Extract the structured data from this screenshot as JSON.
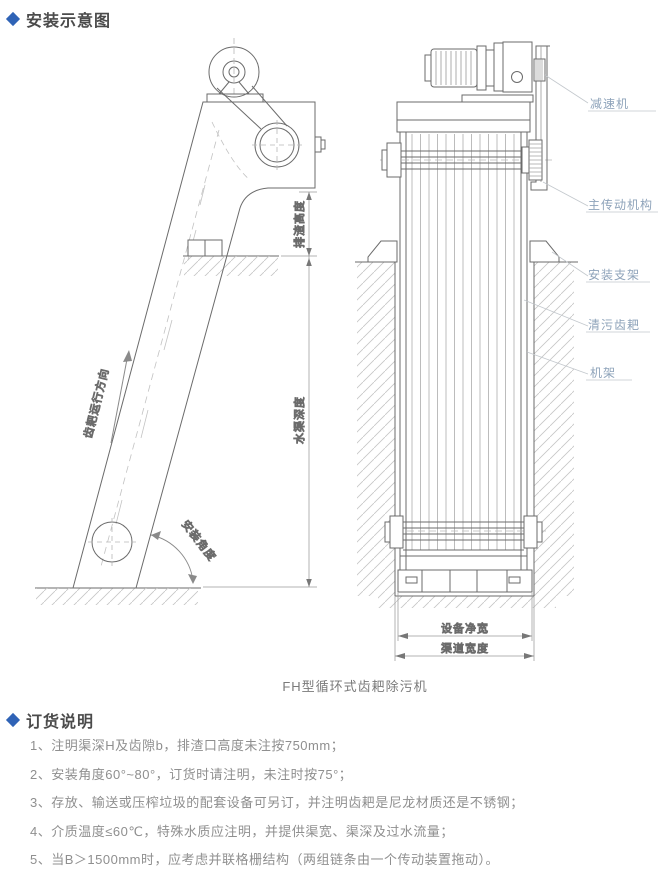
{
  "page": {
    "install_title": "安装示意图",
    "order_title": "订货说明",
    "caption": "FH型循环式齿耙除污机",
    "accent_color": "#2f63b6"
  },
  "diagram": {
    "part_labels": {
      "reducer": "减速机",
      "main_drive": "主传动机构",
      "mount_bracket": "安装支架",
      "cleaning_rake": "清污齿耙",
      "frame": "机架"
    },
    "dim_labels": {
      "discharge_height": "排渣高度",
      "channel_depth": "水渠深度",
      "install_angle": "安装角度",
      "rake_direction": "齿耙运行方向",
      "equipment_width": "设备净宽",
      "channel_width": "渠道宽度"
    }
  },
  "ordering": {
    "items": [
      "1、注明渠深H及齿隙b，排渣口高度未注按750mm；",
      "2、安装角度60°~80°，订货时请注明，未注时按75°；",
      "3、存放、输送或压榨垃圾的配套设备可另订，并注明齿耙是尼龙材质还是不锈钢；",
      "4、介质温度≤60℃，特殊水质应注明，并提供渠宽、渠深及过水流量；",
      "5、当B＞1500mm时，应考虑并联格栅结构（两组链条由一个传动装置拖动）。"
    ]
  }
}
